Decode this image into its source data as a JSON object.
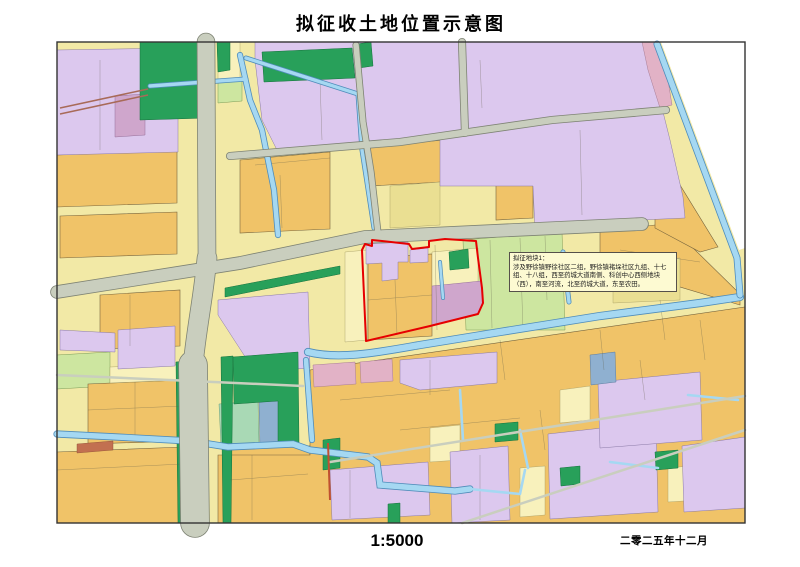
{
  "header": {
    "title": "拟征收土地位置示意图"
  },
  "footer": {
    "scale": "1:5000",
    "date": "二零二五年十二月"
  },
  "annotation": {
    "heading": "拟征地块1：",
    "body": "涉及野徐镇野徐社区二组，野徐镇褚垛社区九组、十七组、十八组，西至药城大道南侧、科创中心西侧地块（西），南至河流，北至药城大道，东至农田。"
  },
  "map": {
    "type": "cadastral-zoning-map",
    "highlight": "proposed-acquisition-parcel-outline"
  },
  "colors": {
    "red_boundary": "#e60000",
    "road": "#c9cebe",
    "water": "#a5d8f2",
    "water_edge": "#4f8cba",
    "parcel_orange": "#f0c368",
    "parcel_lavender": "#dcc8ee",
    "parcel_yellow_base": "#f2e9a6",
    "green_dark": "#28a05a",
    "green_light": "#cde6a0",
    "annotation_bg": "#fdfad2"
  }
}
